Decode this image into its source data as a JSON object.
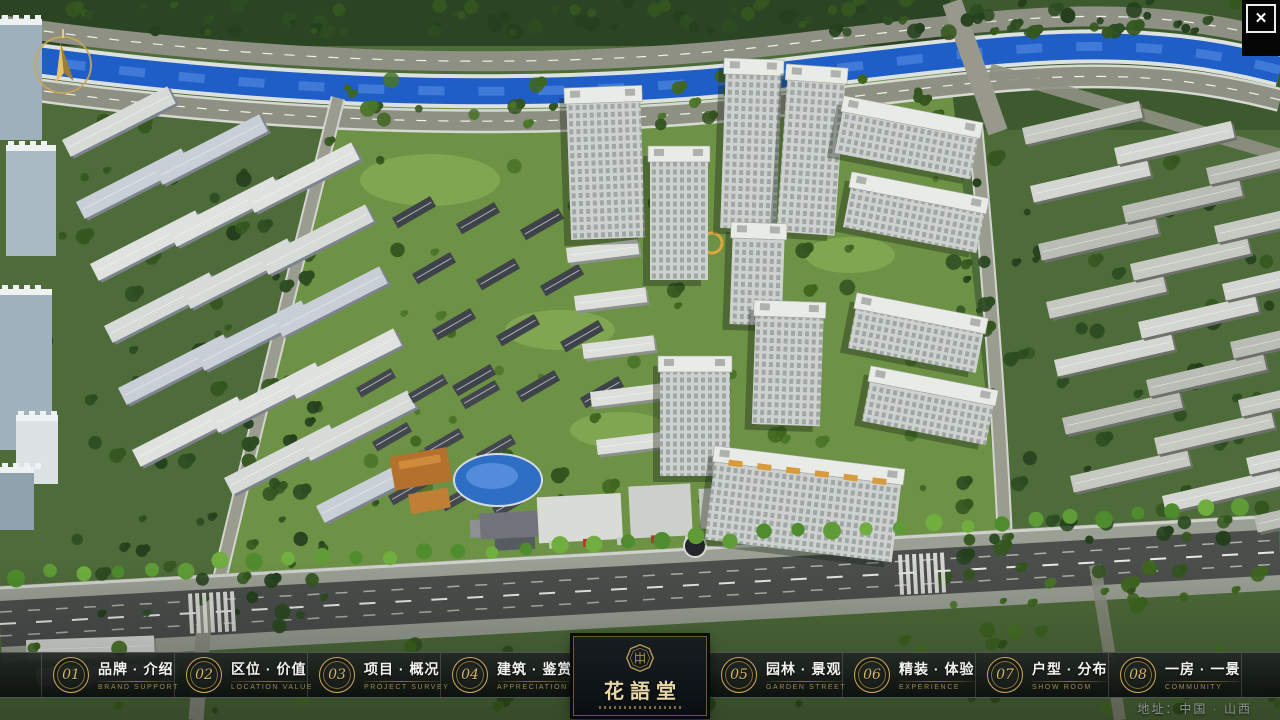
{
  "window": {
    "close_icon": "✕"
  },
  "nav": {
    "items": [
      {
        "num": "01",
        "label": "品牌 · 介绍",
        "sub": "BRAND SUPPORT"
      },
      {
        "num": "02",
        "label": "区位 · 价值",
        "sub": "LOCATION VALUE"
      },
      {
        "num": "03",
        "label": "项目 · 概况",
        "sub": "PROJECT SURVEY"
      },
      {
        "num": "04",
        "label": "建筑 · 鉴赏",
        "sub": "APPRECIATION"
      },
      {
        "num": "05",
        "label": "园林 · 景观",
        "sub": "GARDEN STREET"
      },
      {
        "num": "06",
        "label": "精装 · 体验",
        "sub": "EXPERIENCE"
      },
      {
        "num": "07",
        "label": "户型 · 分布",
        "sub": "SHOW ROOM"
      },
      {
        "num": "08",
        "label": "一房 · 一景",
        "sub": "COMMUNITY"
      }
    ]
  },
  "logo": {
    "title": "花語堂"
  },
  "footer": {
    "address": "地址：中国 · 山西"
  },
  "colors": {
    "accent_gold": "#c9a85e",
    "bar_background": "#151a18",
    "river_blue": "#1e5ec6",
    "road_dark": "#4b4f4c",
    "panel_border": "#6e5b33"
  }
}
